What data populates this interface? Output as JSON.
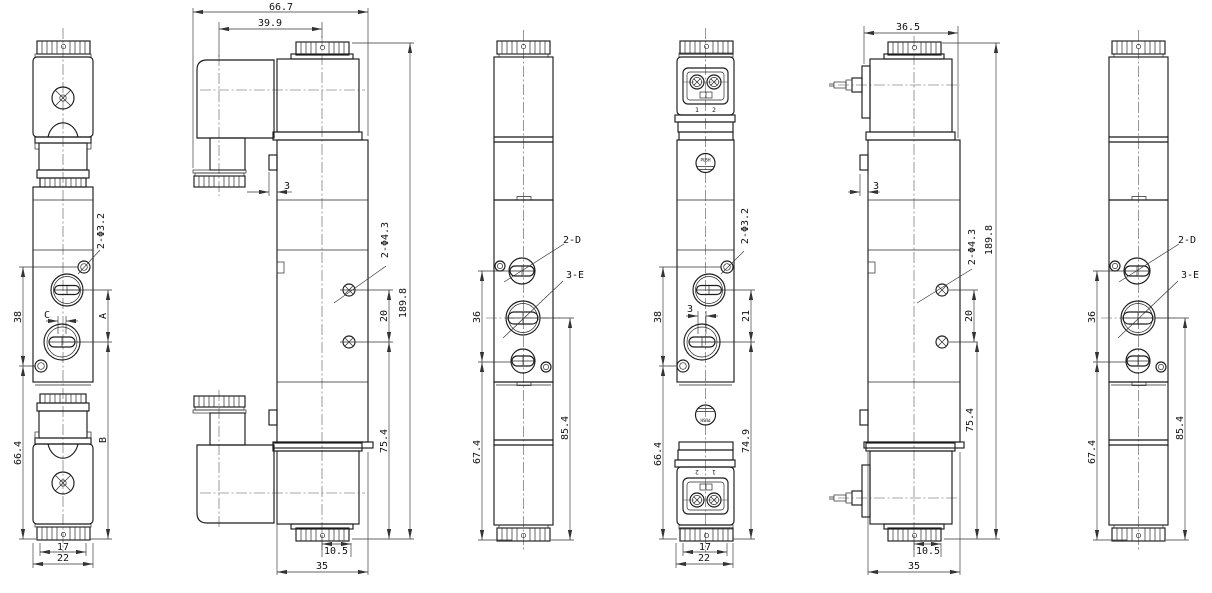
{
  "views": {
    "front_left": {
      "hole_label": "2-Φ3.2",
      "hole_pitch": "38",
      "slot_width": "C",
      "port_pitch": "A",
      "lower_span": "B",
      "lower_height": "66.4",
      "cap_width": "17",
      "body_width": "22"
    },
    "side_left": {
      "overall_width": "66.7",
      "coil_offset": "39.9",
      "tab_width": "3",
      "hole_label": "2-Φ4.3",
      "hole_pitch": "20",
      "overall_height": "189.8",
      "lower_height": "75.4",
      "cap_offset": "10.5",
      "body_depth": "35"
    },
    "back_left": {
      "port_d": "2-D",
      "port_e": "3-E",
      "port_pitch": "36",
      "lower_height": "67.4",
      "port_height": "85.4"
    },
    "front_right": {
      "hole_label": "2-Φ3.2",
      "terminal_1": "1",
      "terminal_2": "2",
      "push_top": "PUSH",
      "slot_width": "3",
      "hole_pitch": "38",
      "port_pitch": "21",
      "lower_height": "66.4",
      "lower_span": "74.9",
      "terminal_2b": "2",
      "terminal_1b": "1",
      "push_bottom": "PUSH",
      "cap_width": "17",
      "body_width": "22"
    },
    "side_right": {
      "overall_width": "36.5",
      "tab_width": "3",
      "hole_label": "2-Φ4.3",
      "hole_pitch": "20",
      "overall_height": "189.8",
      "lower_height": "75.4",
      "cap_offset": "10.5",
      "body_depth": "35"
    },
    "back_right": {
      "port_d": "2-D",
      "port_e": "3-E",
      "port_pitch": "36",
      "lower_height": "67.4",
      "port_height": "85.4"
    }
  }
}
